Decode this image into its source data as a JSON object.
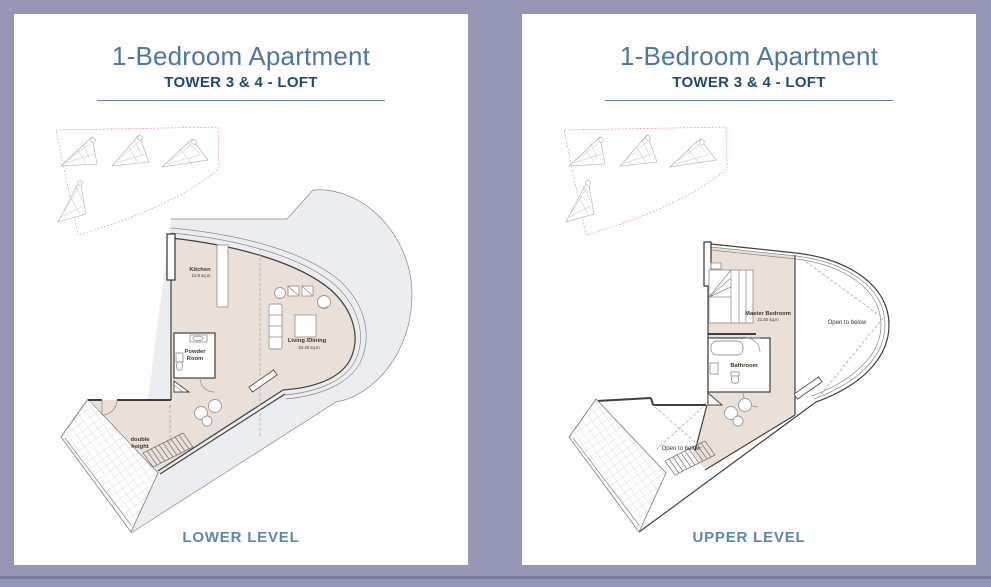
{
  "colors": {
    "background": "#9697b7",
    "page": "#ffffff",
    "title": "#4a77a6",
    "subtitle": "#1c4a72",
    "level_label": "#5b87b2",
    "divider": "#5e84a8",
    "plan_interior": "#ebe0d7",
    "plan_terrace": "#ecedf0",
    "wall": "#3f3f3f",
    "keyplan_boundary": "#e09999",
    "bottom_line": "#787ca1"
  },
  "pages": [
    {
      "title": "1-Bedroom Apartment",
      "subtitle": "TOWER 3 & 4 - LOFT",
      "level_label": "LOWER LEVEL",
      "labels": {
        "kitchen": "Kitchen",
        "kitchen_area": "13.8 sq.m",
        "powder_1": "Powder",
        "powder_2": "Room",
        "living": "Living /Dining",
        "living_area": "34.40  sq.m",
        "double_1": "double",
        "double_2": "height"
      }
    },
    {
      "title": "1-Bedroom Apartment",
      "subtitle": "TOWER 3 & 4 - LOFT",
      "level_label": "UPPER LEVEL",
      "labels": {
        "master": "Master Bedroom",
        "master_area": "21.60 sq.m",
        "bathroom": "Bathroom",
        "open_right": "Open to below",
        "open_left": "Open to below"
      }
    }
  ]
}
